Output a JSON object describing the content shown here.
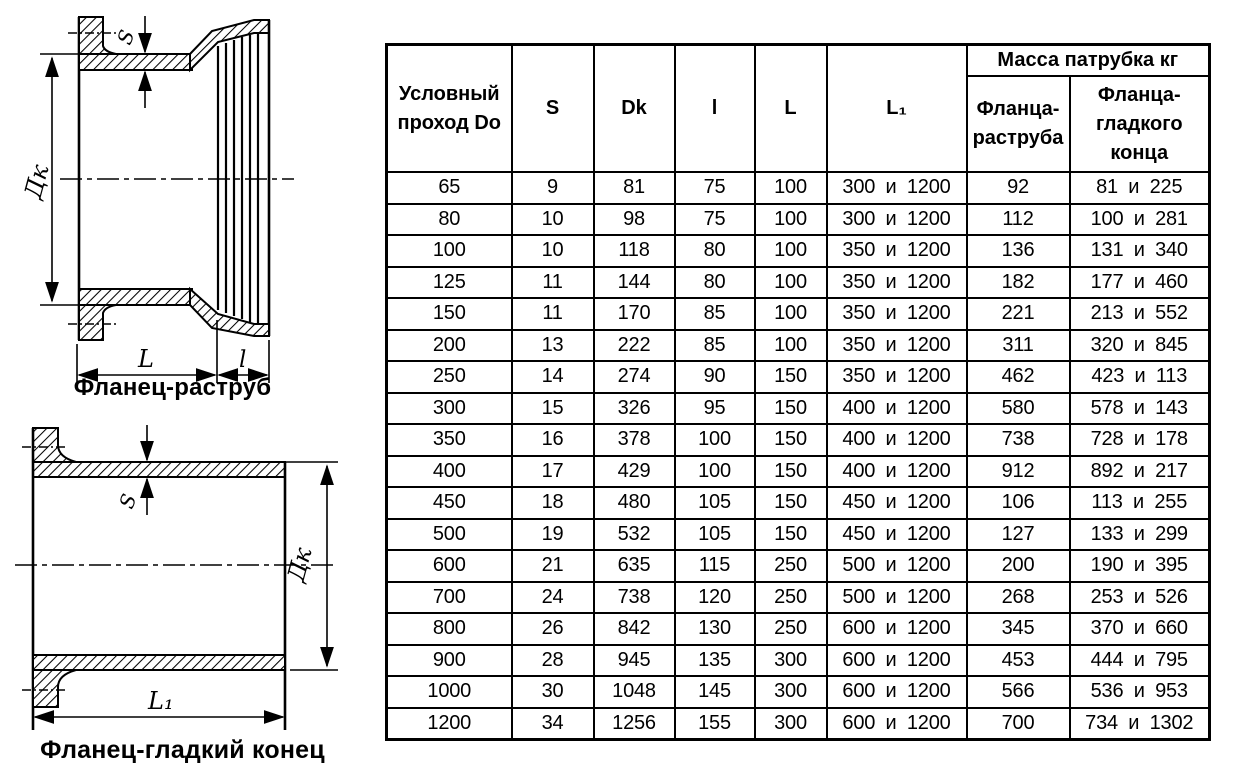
{
  "page": {
    "background": "#ffffff",
    "line_color": "#000000"
  },
  "drawings": {
    "top": {
      "caption": "Фланец-раструб",
      "labels": {
        "diameter": "Дк",
        "wall": "S",
        "length": "L",
        "socket": "l"
      }
    },
    "bottom": {
      "caption": "Фланец-гладкий конец",
      "labels": {
        "diameter": "Дк",
        "wall": "S",
        "length": "L₁"
      }
    }
  },
  "table": {
    "columns": [
      "Условный\nпроход Do",
      "S",
      "Dk",
      "l",
      "L",
      "L₁"
    ],
    "mass_group": "Масса патрубка кг",
    "mass_columns": [
      "Фланца-\nраструба",
      "Фланца-\nгладкого\nконца"
    ],
    "rows": [
      [
        "65",
        "9",
        "81",
        "75",
        "100",
        "300 и 1200",
        "92",
        "81 и 225"
      ],
      [
        "80",
        "10",
        "98",
        "75",
        "100",
        "300 и 1200",
        "112",
        "100 и 281"
      ],
      [
        "100",
        "10",
        "118",
        "80",
        "100",
        "350 и 1200",
        "136",
        "131 и 340"
      ],
      [
        "125",
        "11",
        "144",
        "80",
        "100",
        "350 и 1200",
        "182",
        "177 и 460"
      ],
      [
        "150",
        "11",
        "170",
        "85",
        "100",
        "350 и 1200",
        "221",
        "213 и 552"
      ],
      [
        "200",
        "13",
        "222",
        "85",
        "100",
        "350 и 1200",
        "311",
        "320 и 845"
      ],
      [
        "250",
        "14",
        "274",
        "90",
        "150",
        "350 и 1200",
        "462",
        "423 и 113"
      ],
      [
        "300",
        "15",
        "326",
        "95",
        "150",
        "400 и 1200",
        "580",
        "578 и 143"
      ],
      [
        "350",
        "16",
        "378",
        "100",
        "150",
        "400 и 1200",
        "738",
        "728 и 178"
      ],
      [
        "400",
        "17",
        "429",
        "100",
        "150",
        "400 и 1200",
        "912",
        "892 и 217"
      ],
      [
        "450",
        "18",
        "480",
        "105",
        "150",
        "450 и 1200",
        "106",
        "113 и 255"
      ],
      [
        "500",
        "19",
        "532",
        "105",
        "150",
        "450 и 1200",
        "127",
        "133 и 299"
      ],
      [
        "600",
        "21",
        "635",
        "115",
        "250",
        "500 и 1200",
        "200",
        "190 и 395"
      ],
      [
        "700",
        "24",
        "738",
        "120",
        "250",
        "500 и 1200",
        "268",
        "253 и 526"
      ],
      [
        "800",
        "26",
        "842",
        "130",
        "250",
        "600 и 1200",
        "345",
        "370 и 660"
      ],
      [
        "900",
        "28",
        "945",
        "135",
        "300",
        "600 и 1200",
        "453",
        "444 и 795"
      ],
      [
        "1000",
        "30",
        "1048",
        "145",
        "300",
        "600 и 1200",
        "566",
        "536 и 953"
      ],
      [
        "1200",
        "34",
        "1256",
        "155",
        "300",
        "600 и 1200",
        "700",
        "734 и 1302"
      ]
    ]
  }
}
